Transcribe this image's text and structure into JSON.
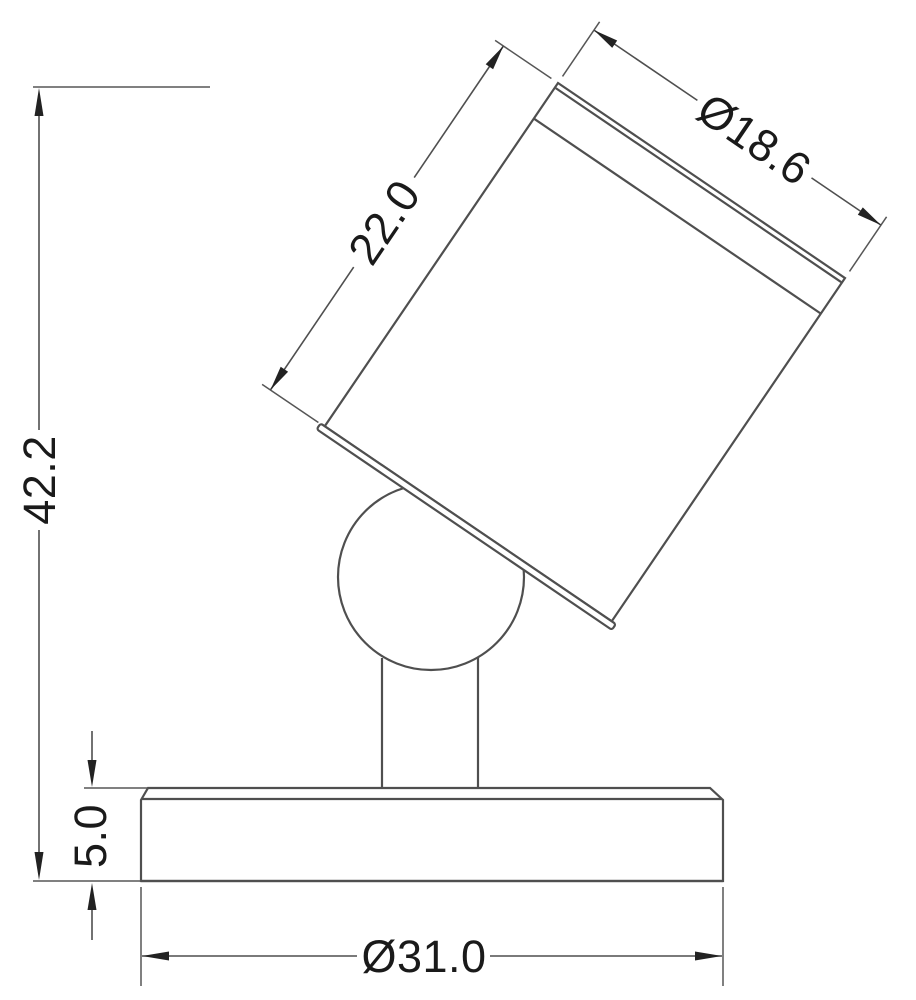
{
  "drawing": {
    "kind": "technical-dimension-drawing",
    "dimensions": {
      "overall_height": "42.2",
      "head_length": "22.0",
      "head_diameter": "Ø18.6",
      "base_thickness": "5.0",
      "base_diameter": "Ø31.0"
    },
    "colors": {
      "background": "#ffffff",
      "object_line": "#4f4f4f",
      "dimension_line": "#565656",
      "arrow": "#222222",
      "text": "#1a1a1a"
    }
  }
}
